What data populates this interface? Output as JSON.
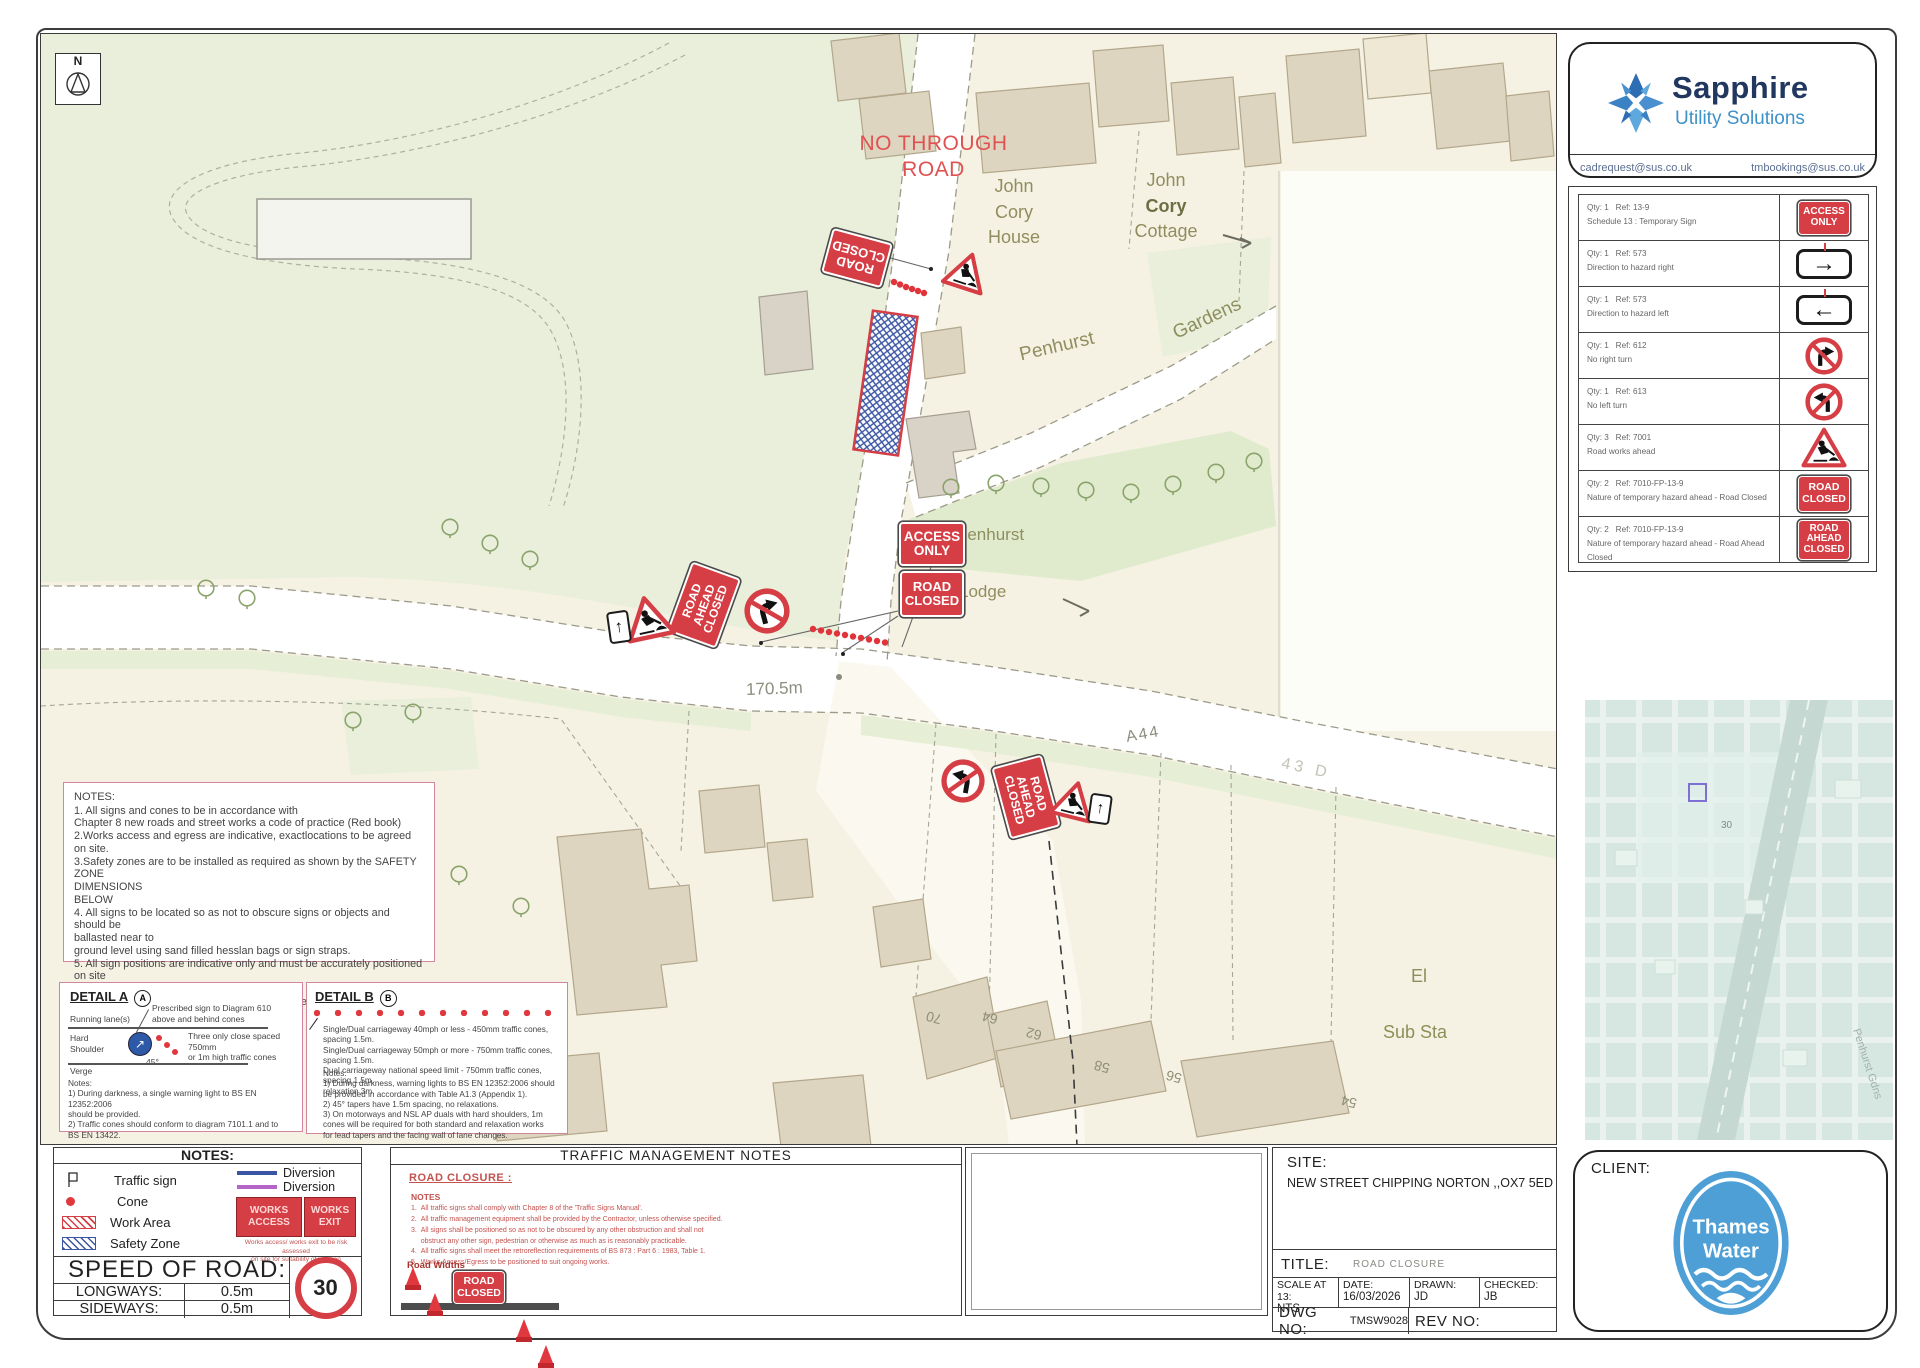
{
  "map": {
    "north": "N",
    "no_through_road": "NO THROUGH ROAD",
    "labels": {
      "john_cory_house": [
        "John",
        "Cory",
        "House"
      ],
      "john_cory_cottage": [
        "John",
        "Cory",
        "Cottage"
      ],
      "gardens": "Gardens",
      "penhurst_road": "Penhurst",
      "penhurst_lodge": [
        "Penhurst",
        "Lodge"
      ],
      "distance": "170.5m",
      "a44": "A44",
      "faint_road": "43 D",
      "el_sub_sta": [
        "El",
        "Sub Sta"
      ],
      "house_numbers": [
        "70",
        "64",
        "62",
        "58",
        "56",
        "54"
      ]
    },
    "signs": {
      "access_only": [
        "ACCESS",
        "ONLY"
      ],
      "road_closed": [
        "ROAD",
        "CLOSED"
      ],
      "road_ahead_closed": [
        "ROAD",
        "AHEAD",
        "CLOSED"
      ]
    },
    "notes_box": {
      "title": "NOTES:",
      "body": "1. All signs and cones to be in accordance with\nChapter 8 new roads and street works a code of practice (Red book)\n2.Works access and egress are indicative, exactlocations to be agreed on site.\n3.Safety zones are to be installed as required as shown by the SAFETY ZONE\nDIMENSIONS\nBELOW\n4. All signs to be located so as not to obscure signs or objects and should be\nballasted near to\nground level using sand filled hesslan bags or sign straps.\n5. All sign positions are indicative only and must be accurately positioned on site\nwith good\nvisibility and be clear of and obstructions or vegetation at all times.\n6. Drawing not to scale"
    },
    "detail_a": {
      "title": "DETAIL A",
      "badge": "A",
      "callout": "Prescribed sign to Diagram 610\nabove and behind cones",
      "running_lane": "Running lane(s)",
      "hard_shoulder": "Hard\nShoulder",
      "cones_note": "Three only close spaced 750mm\nor 1m high traffic cones",
      "angle": "45°",
      "verge": "Verge",
      "notes": "Notes:\n1) During darkness, a single warning light to BS EN 12352:2006\nshould be provided.\n2) Traffic cones should conform to diagram 7101.1 and to\nBS EN 13422."
    },
    "detail_b": {
      "title": "DETAIL B",
      "badge": "B",
      "body": "Single/Dual carriageway 40mph or less - 450mm traffic cones, spacing 1.5m.\nSingle/Dual carriageway 50mph or more - 750mm traffic cones, spacing 1.5m.\nDual carriageway national speed limit - 750mm traffic cones, spacing 1.5m,\nrelaxation 3m.",
      "notes": "Notes:\n1) During darkness, warning lights to BS EN 12352:2006 should\nbe provided in accordance with Table A1.3 (Appendix 1).\n2) 45° tapers have 1.5m spacing, no relaxations.\n3) On motorways and NSL AP duals with hard shoulders, 1m\ncones will be required for both standard and relaxation works\nfor lead tapers and the facing wall of lane changes."
    }
  },
  "sidebar": {
    "brand": "Sapphire",
    "brand_sub": "Utility Solutions",
    "email_left": "cadrequest@sus.co.uk",
    "email_right": "tmbookings@sus.co.uk",
    "schedule": [
      {
        "qty": "Qty: 1   Ref: 13-9",
        "desc": "Schedule 13 : Temporary Sign"
      },
      {
        "qty": "Qty: 1   Ref: 573",
        "desc": "Direction to hazard right"
      },
      {
        "qty": "Qty: 1   Ref: 573",
        "desc": "Direction to hazard left"
      },
      {
        "qty": "Qty: 1   Ref: 612",
        "desc": "No right turn"
      },
      {
        "qty": "Qty: 1   Ref: 613",
        "desc": "No left turn"
      },
      {
        "qty": "Qty: 3   Ref: 7001",
        "desc": "Road works ahead"
      },
      {
        "qty": "Qty: 2   Ref: 7010-FP-13-9",
        "desc": "Nature of temporary hazard ahead - Road Closed"
      },
      {
        "qty": "Qty: 2   Ref: 7010-FP-13-9",
        "desc": "Nature of temporary hazard ahead - Road Ahead Closed"
      }
    ]
  },
  "legend": {
    "header": "NOTES:",
    "traffic_sign": "Traffic sign",
    "cone": "Cone",
    "work_area": "Work Area",
    "safety_zone": "Safety Zone",
    "diversion1": "Diversion",
    "diversion2": "Diversion",
    "works_access": [
      "WORKS",
      "ACCESS"
    ],
    "works_exit": [
      "WORKS",
      "EXIT"
    ],
    "works_note": "Works access/ works exit to be risk assessed\non site for suitability of location",
    "speed_header": "SPEED OF ROAD:",
    "longways_label": "LONGWAYS:",
    "longways_value": "0.5m",
    "sideways_label": "SIDEWAYS:",
    "sideways_value": "0.5m",
    "speed_limit": "30"
  },
  "tmn": {
    "header": "TRAFFIC MANAGEMENT NOTES",
    "subtitle": "ROAD CLOSURE :",
    "notes_label": "NOTES",
    "notes": "1.  All traffic signs shall comply with Chapter 8 of the 'Traffic Signs Manual'.\n2.  All traffic management equipment shall be provided by the Contractor, unless otherwise specified.\n3.  All signs shall be positioned so as not to be obscured by any other obstruction and shall not\n     obstruct any other sign, pedestrian or otherwise as much as is reasonably practicable.\n4.  All traffic signs shall meet the retroreflection requirements of BS 873 : Part 6 : 1983, Table 1.\n5.  Works Access/Egress to be positioned to suit ongoing works.",
    "road_widths": "Road Widths"
  },
  "titleblock": {
    "site_label": "SITE:",
    "site_value": "NEW STREET CHIPPING NORTON ,,OX7 5ED",
    "title_label": "TITLE:",
    "title_value": "ROAD CLOSURE",
    "scale_label": "SCALE AT 13:",
    "scale_value": "NTS",
    "date_label": "DATE:",
    "date_value": "16/03/2026",
    "drawn_label": "DRAWN:",
    "drawn_value": "JD",
    "checked_label": "CHECKED:",
    "checked_value": "JB",
    "dwg_label": "DWG NO:",
    "dwg_value": "TMSW9028",
    "rev_label": "REV NO:",
    "rev_value": ""
  },
  "client": {
    "label": "CLIENT:",
    "logo_line1": "Thames",
    "logo_line2": "Water"
  },
  "inset": {
    "street_label": "Penhurst Gdns",
    "marker_label": "30"
  }
}
